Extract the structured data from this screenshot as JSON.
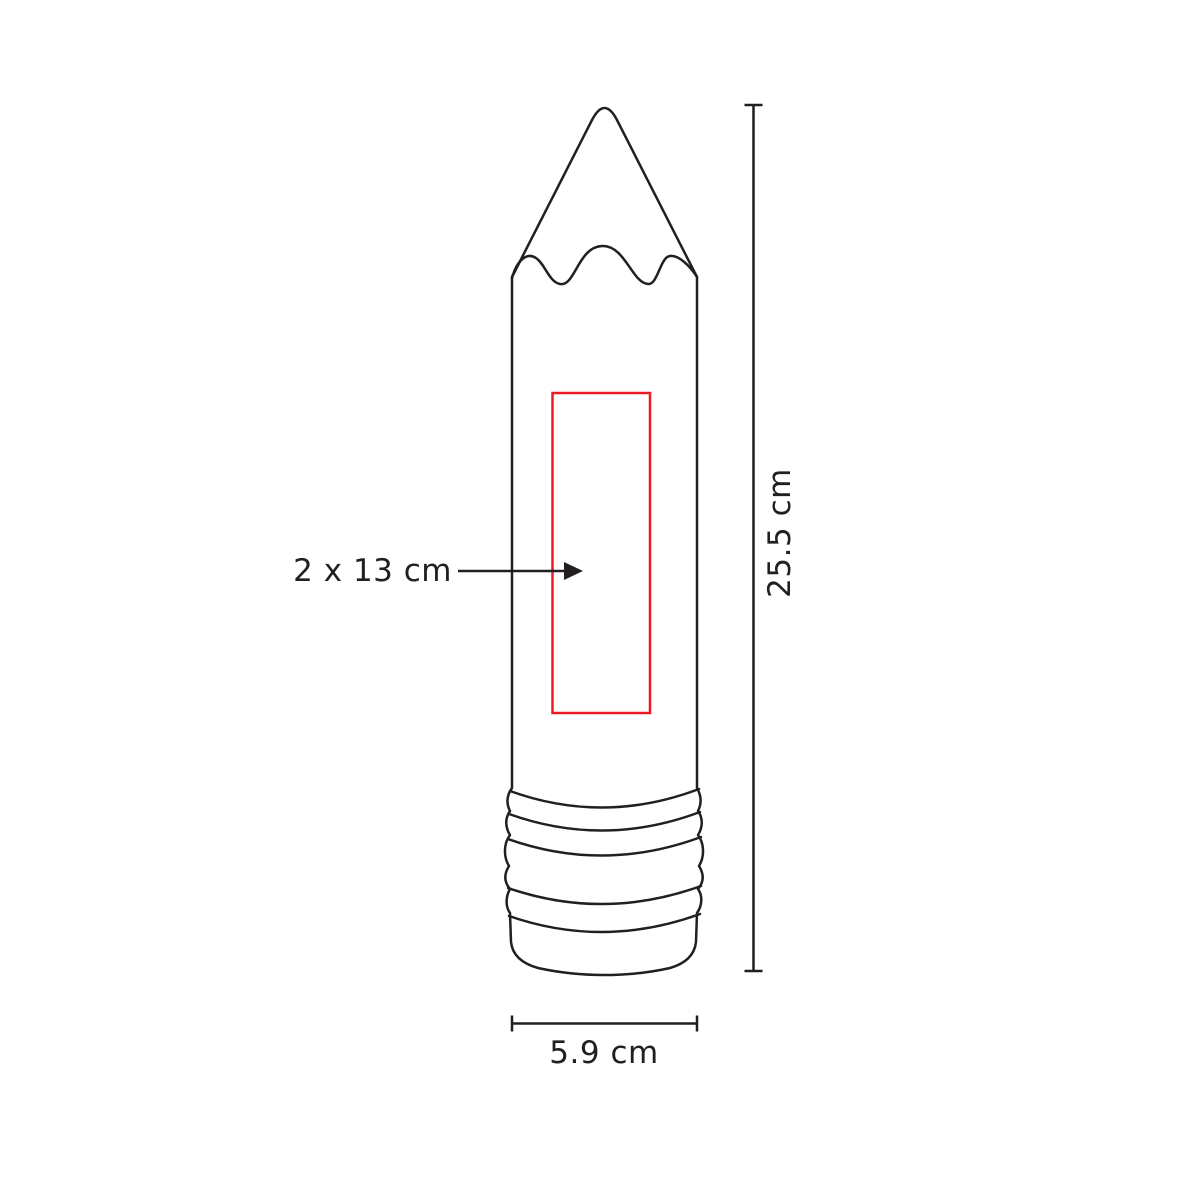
{
  "diagram": {
    "shape": "pencil",
    "labels": {
      "print_area": "2 x 13 cm",
      "height": "25.5 cm",
      "width": "5.9 cm"
    },
    "colors": {
      "line": "#231f20",
      "print_area": "#ed1c24",
      "background": "#ffffff"
    }
  }
}
